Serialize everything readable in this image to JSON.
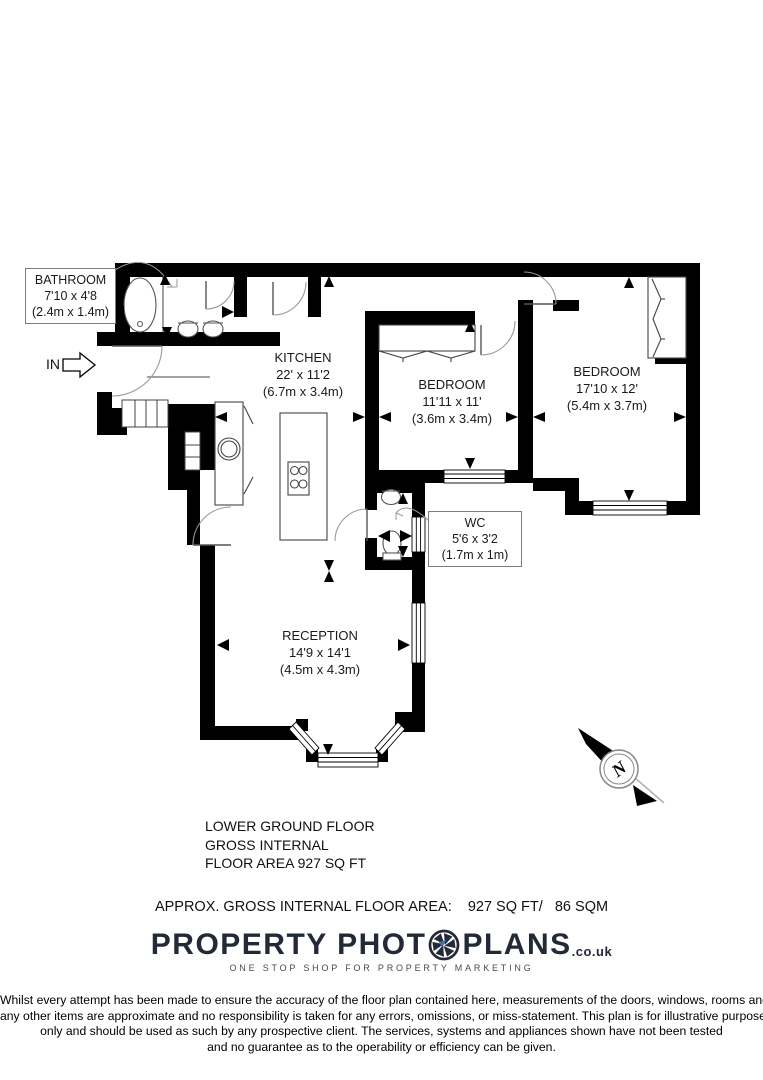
{
  "plan": {
    "entrance_label": "IN",
    "compass_north": "N",
    "rooms": {
      "bathroom": {
        "name": "BATHROOM",
        "size_imperial": "7'10 x 4'8",
        "size_metric": "(2.4m x 1.4m)"
      },
      "kitchen": {
        "name": "KITCHEN",
        "size_imperial": "22' x 11'2",
        "size_metric": "(6.7m x 3.4m)"
      },
      "bedroom1": {
        "name": "BEDROOM",
        "size_imperial": "11'11 x 11'",
        "size_metric": "(3.6m x 3.4m)"
      },
      "bedroom2": {
        "name": "BEDROOM",
        "size_imperial": "17'10 x 12'",
        "size_metric": "(5.4m x 3.7m)"
      },
      "wc": {
        "name": "WC",
        "size_imperial": "5'6 x 3'2",
        "size_metric": "(1.7m x 1m)"
      },
      "reception": {
        "name": "RECEPTION",
        "size_imperial": "14'9 x 14'1",
        "size_metric": "(4.5m x 4.3m)"
      }
    }
  },
  "summary": {
    "floor_line1": "LOWER GROUND FLOOR",
    "floor_line2": "GROSS INTERNAL",
    "floor_line3": "FLOOR AREA 927 SQ FT",
    "area_line": "APPROX. GROSS INTERNAL FLOOR AREA:    927 SQ FT/   86 SQM"
  },
  "branding": {
    "logo_text_left": "PROPERTY PHOT",
    "logo_text_right": "PLANS",
    "logo_domain": ".co.uk",
    "tagline": "ONE STOP SHOP FOR PROPERTY MARKETING",
    "colors": {
      "logo": "#232937",
      "tagline": "#4a4a4a",
      "accent_blue": "#3f6fa8"
    }
  },
  "disclaimer": {
    "line1": "Whilst every attempt has been made to ensure the accuracy of the floor plan contained here, measurements of the doors, windows, rooms and",
    "line2": "any other items are approximate and no responsibility is taken for any errors, omissions, or miss-statement. This plan is for illustrative purposes",
    "line3": "only and should be used as such by any prospective client. The services, systems and appliances shown have not been tested",
    "line4": "and no guarantee as to the operability or efficiency can be given."
  }
}
